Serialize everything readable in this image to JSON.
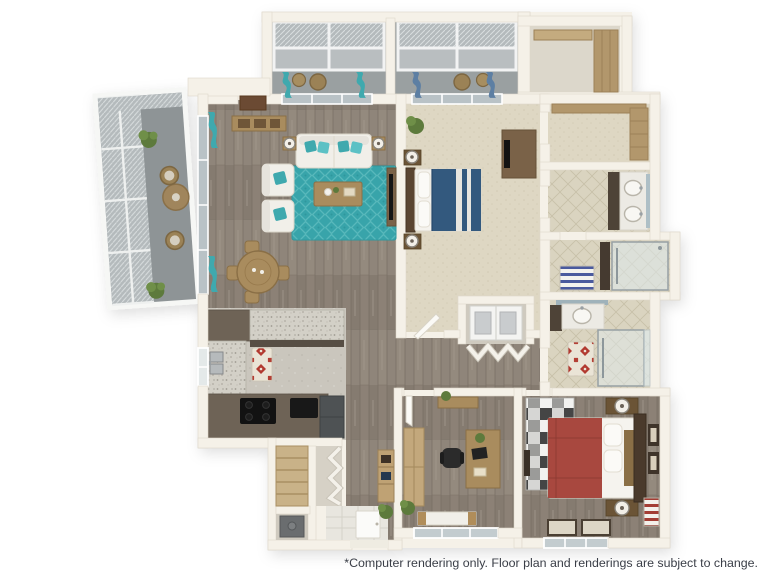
{
  "page": {
    "background": "#ffffff"
  },
  "disclaimer": {
    "text": "*Computer rendering only. Floor plan and renderings are subject to change.",
    "color": "#3a3e47"
  },
  "floor_plan": {
    "type": "3d-floor-plan-rendering",
    "view": "isometric top-down",
    "rooms": [
      {
        "name": "screened-patio-left"
      },
      {
        "name": "screened-balcony-top"
      },
      {
        "name": "living-room"
      },
      {
        "name": "dining-area"
      },
      {
        "name": "kitchen"
      },
      {
        "name": "entry"
      },
      {
        "name": "pantry-closet"
      },
      {
        "name": "utility-closet"
      },
      {
        "name": "hallway"
      },
      {
        "name": "laundry-closet"
      },
      {
        "name": "master-bedroom"
      },
      {
        "name": "walk-in-closet"
      },
      {
        "name": "master-closet"
      },
      {
        "name": "master-bathroom-double-vanity"
      },
      {
        "name": "master-shower-room"
      },
      {
        "name": "second-bathroom"
      },
      {
        "name": "office-den"
      },
      {
        "name": "second-bedroom"
      }
    ],
    "colors": {
      "wall": "#f5f1e8",
      "wood_floor": "#8c8176",
      "carpet": "#ded7c3",
      "bath_tile": "#dad4c0",
      "kitchen_tile": "#cac6bd",
      "granite_counter": "#d3d0c7",
      "dark_counter": "#6e6356",
      "patio_floor": "#8e9496",
      "accent_teal": "#3fa9ae",
      "teal_rug": "#38a4aa",
      "bed_blue": "#33597e",
      "bed_red": "#a8483f",
      "red_rug": "#b23a30",
      "screen_mesh": "#b4babc"
    }
  }
}
